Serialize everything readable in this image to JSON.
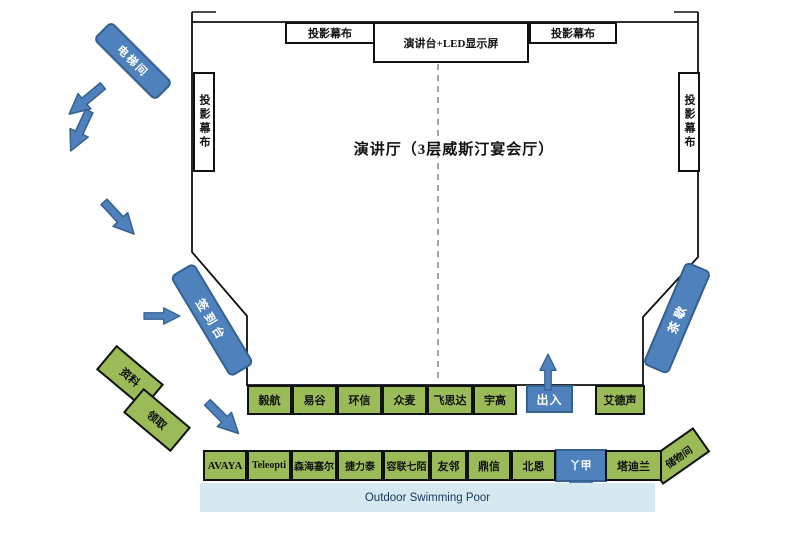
{
  "venue": {
    "title": "演讲厅（3层威斯汀宴会厅）",
    "top_screens": {
      "left": "投影幕布",
      "center": "演讲台+LED显示屏",
      "right": "投影幕布"
    },
    "side_screens": {
      "left": "投影幕布",
      "right": "投影幕布"
    }
  },
  "flow": {
    "elevator_label": "电梯间",
    "sign_in_label": "签到台",
    "tea_break_label": "茶歇",
    "entry_exit_label": "出入",
    "down_exit_label": "丫甲",
    "pickup_upper_label": "资料",
    "pickup_lower_label": "领取",
    "storage_label": "储物间"
  },
  "booths": {
    "row1": [
      "毅航",
      "易谷",
      "环信",
      "众麦",
      "飞思达",
      "宇高"
    ],
    "row1_right": "艾德声",
    "row2": [
      "AVAYA",
      "Teleopti",
      "森海塞尔",
      "捷力泰",
      "容联七陌",
      "友邻",
      "鼎信",
      "北恩"
    ],
    "row2_right": "塔迪兰"
  },
  "pool": {
    "label": "Outdoor Swimming Poor"
  },
  "colors": {
    "booth_green": "#9BBB59",
    "shape_blue": "#4F81BD",
    "shape_blue_border": "#35618E",
    "pool_blue": "#D6E9F1",
    "wall": "#111111"
  }
}
